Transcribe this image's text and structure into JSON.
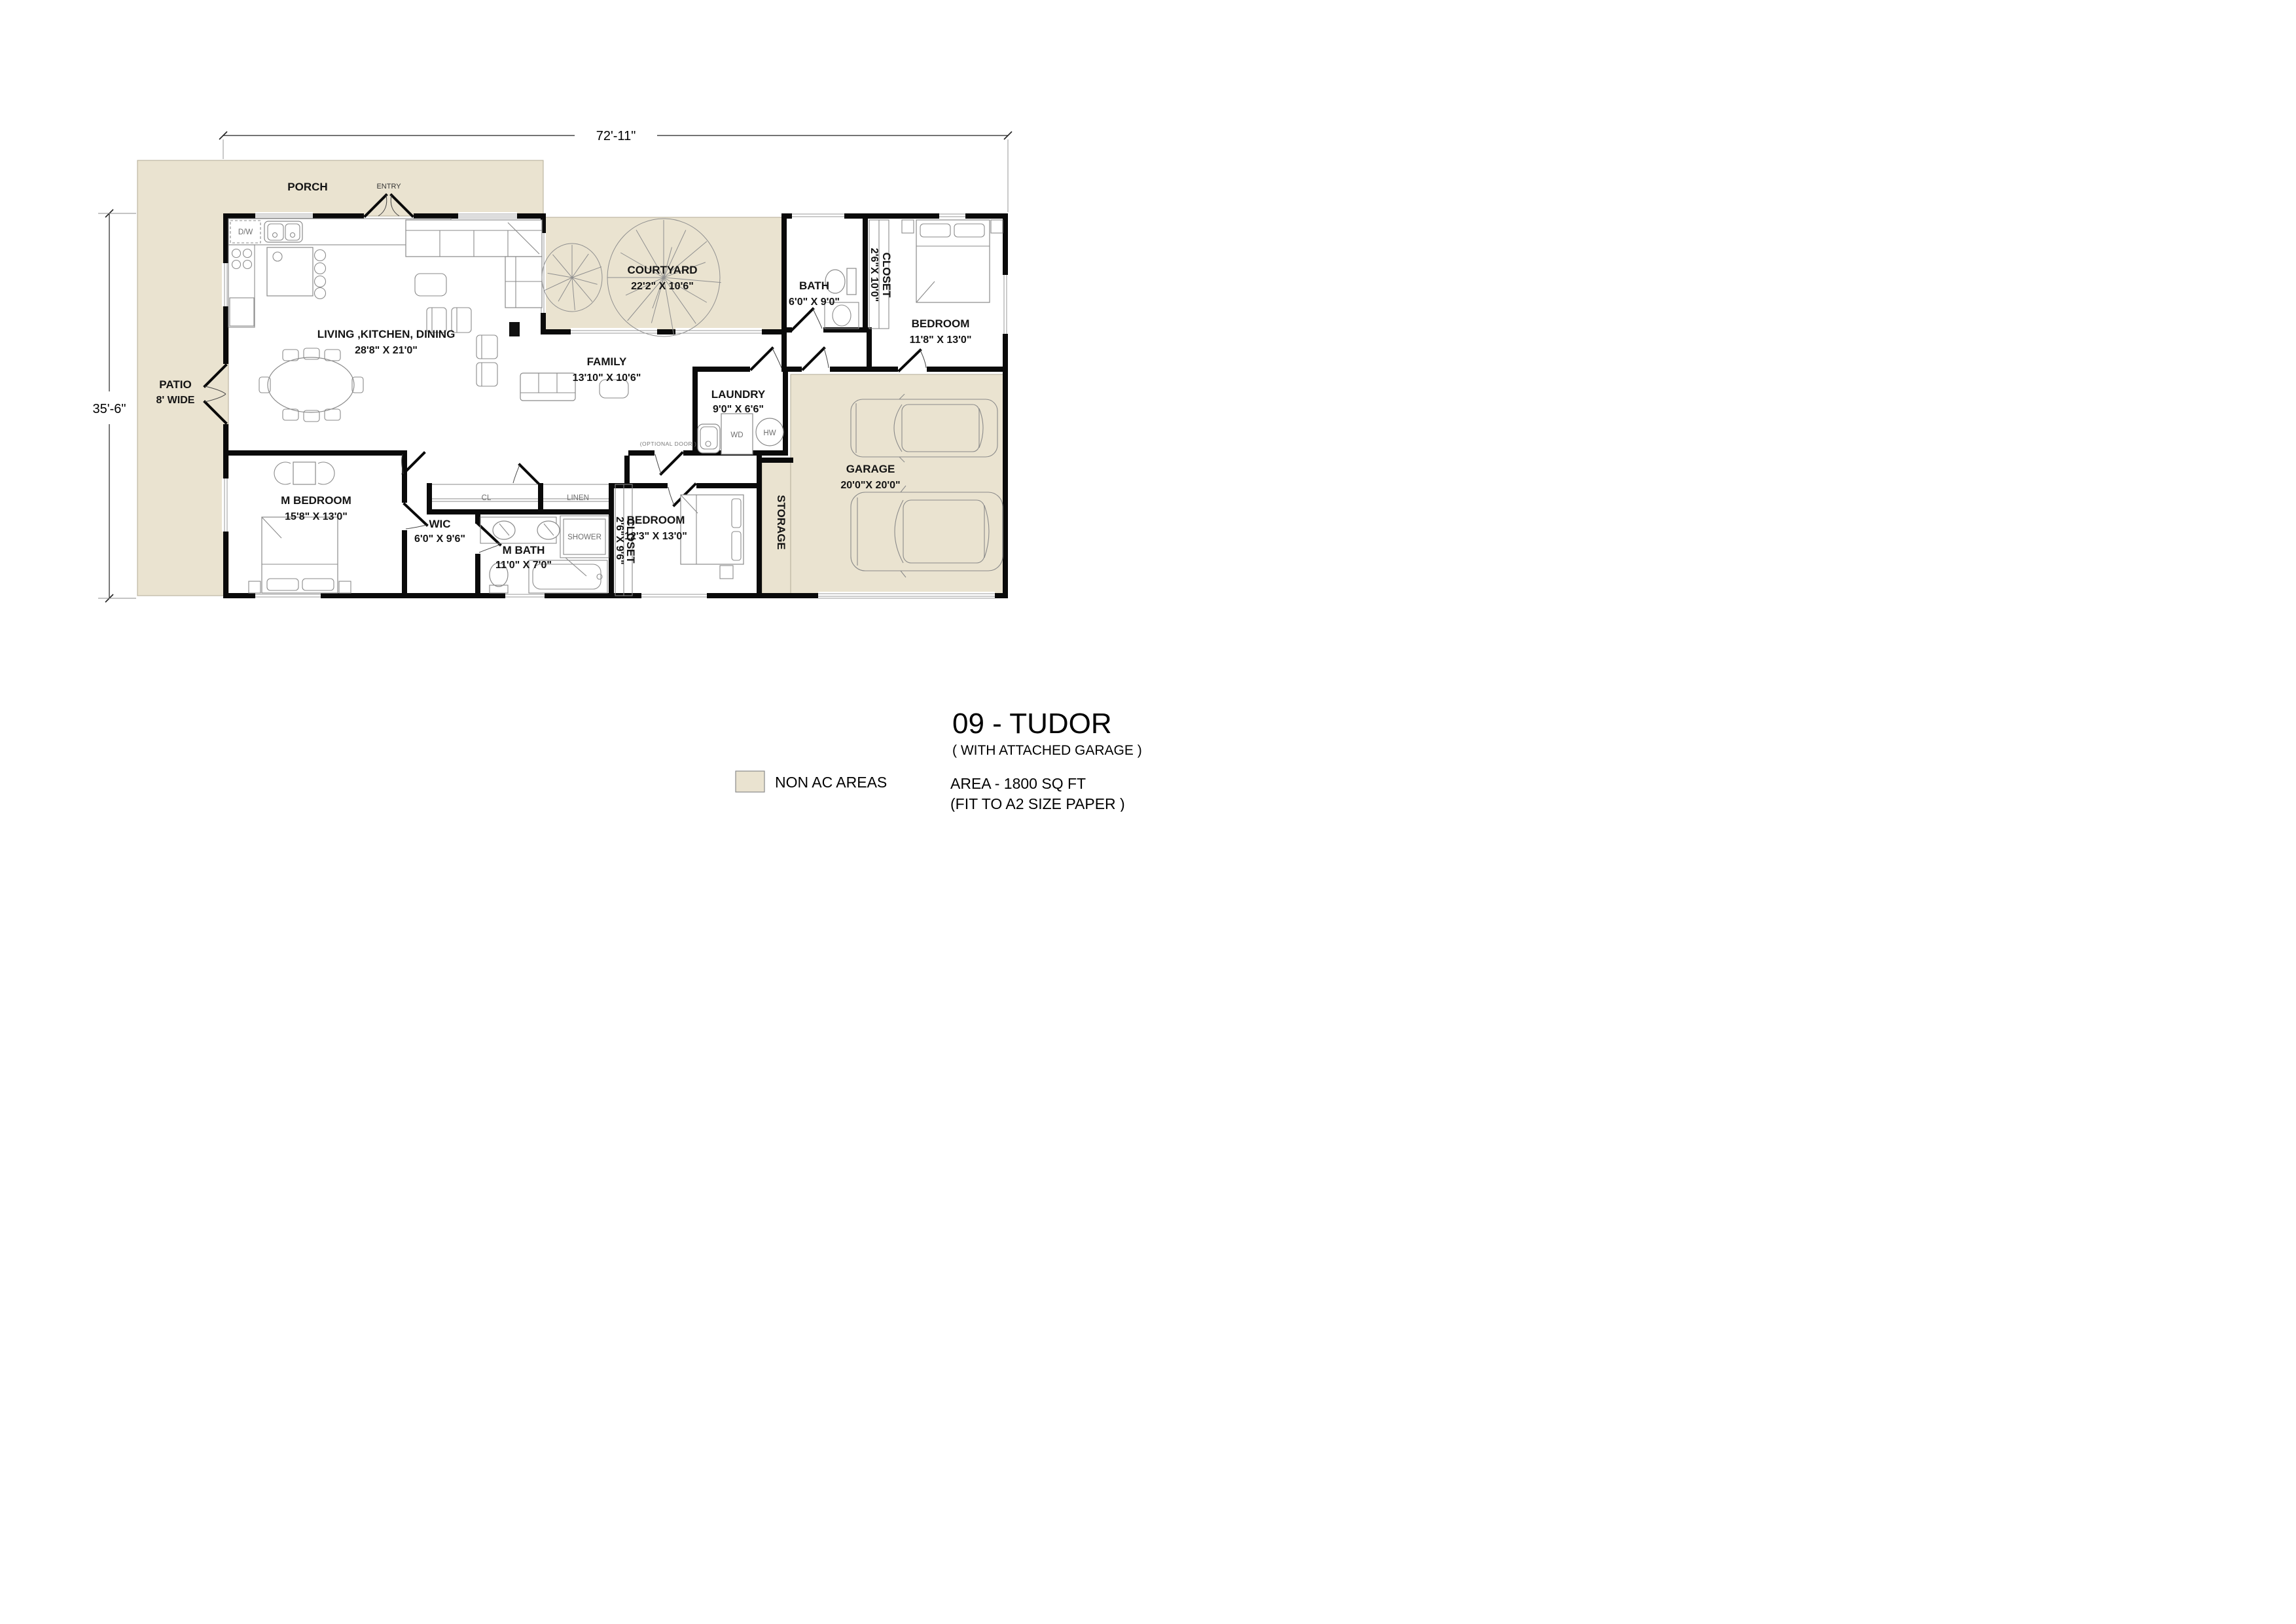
{
  "dimensions": {
    "overall_width": "72'-11\"",
    "overall_height": "35'-6\""
  },
  "rooms": {
    "porch": {
      "name": "PORCH"
    },
    "entry": {
      "name": "ENTRY"
    },
    "living": {
      "name": "LIVING ,KITCHEN, DINING",
      "size": "28'8\" X 21'0\""
    },
    "courtyard": {
      "name": "COURTYARD",
      "size": "22'2\" X 10'6\""
    },
    "bath": {
      "name": "BATH",
      "size": "6'0\" X 9'0\""
    },
    "closet_bedroom1": {
      "name": "CLOSET",
      "size": "2'6\"X 10'0\""
    },
    "bedroom1": {
      "name": "BEDROOM",
      "size": "11'8\" X 13'0\""
    },
    "patio": {
      "name": "PATIO",
      "size": "8' WIDE"
    },
    "family": {
      "name": "FAMILY",
      "size": "13'10\" X 10'6\""
    },
    "laundry": {
      "name": "LAUNDRY",
      "size": "9'0\" X 6'6\""
    },
    "garage": {
      "name": "GARAGE",
      "size": "20'0\"X 20'0\""
    },
    "m_bedroom": {
      "name": "M BEDROOM",
      "size": "15'8\" X 13'0\""
    },
    "wic": {
      "name": "WIC",
      "size": "6'0\" X 9'6\""
    },
    "m_bath": {
      "name": "M BATH",
      "size": "11'0\" X 7'0\""
    },
    "cl": {
      "name": "CL"
    },
    "linen": {
      "name": "LINEN"
    },
    "shower": {
      "name": "SHOWER"
    },
    "closet_bedroom2": {
      "name": "CLOSET",
      "size": "2'6\"X 9'6\""
    },
    "bedroom2": {
      "name": "BEDROOM",
      "size": "12'3\" X 13'0\""
    },
    "storage": {
      "name": "STORAGE"
    }
  },
  "fixtures": {
    "dishwasher": "D/W",
    "washer_dryer": "WD",
    "water_heater": "HW",
    "optional_door": "(OPTIONAL DOOR )"
  },
  "title_block": {
    "title": "09 - TUDOR",
    "subtitle": "( WITH  ATTACHED GARAGE )",
    "area": "AREA - 1800 SQ FT",
    "paper": "(FIT TO A2 SIZE PAPER )"
  },
  "legend": {
    "non_ac": "NON AC AREAS",
    "non_ac_color": "#EAE3D0"
  }
}
